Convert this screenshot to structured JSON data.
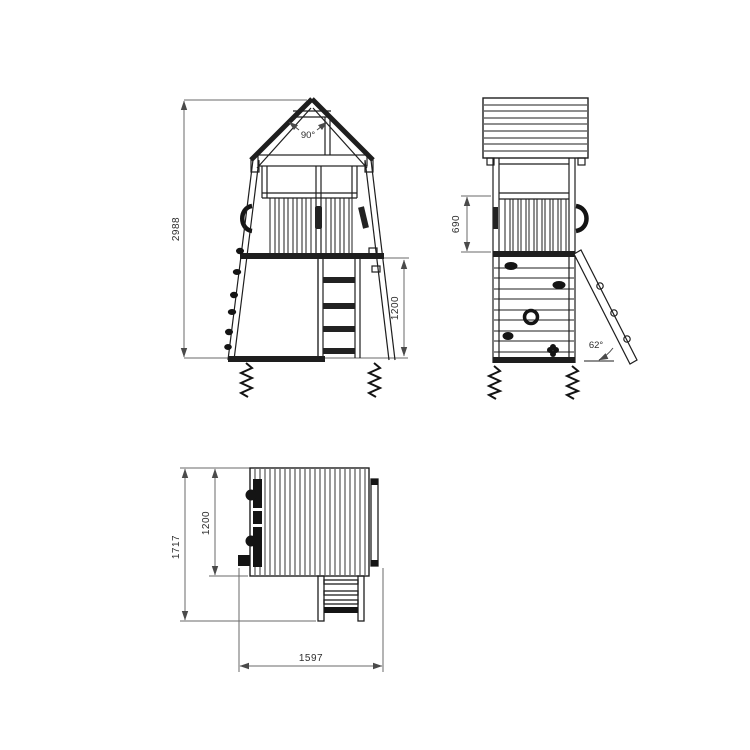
{
  "drawing": {
    "kind": "technical-drawing",
    "subject": "wooden play tower with gable roof, climbing wall, railing platform and access ladders (front view, side view, plan view)",
    "colors": {
      "line": "#1e1e1e",
      "dimension": "#6a6a6a",
      "background": "#ffffff"
    },
    "front": {
      "overall_height": "2988",
      "platform_height": "1200",
      "roof_angle": "90°"
    },
    "side": {
      "railing_height": "690",
      "ladder_angle": "62°"
    },
    "plan": {
      "overall_depth": "1717",
      "tower_depth": "1200",
      "overall_width": "1597"
    }
  }
}
